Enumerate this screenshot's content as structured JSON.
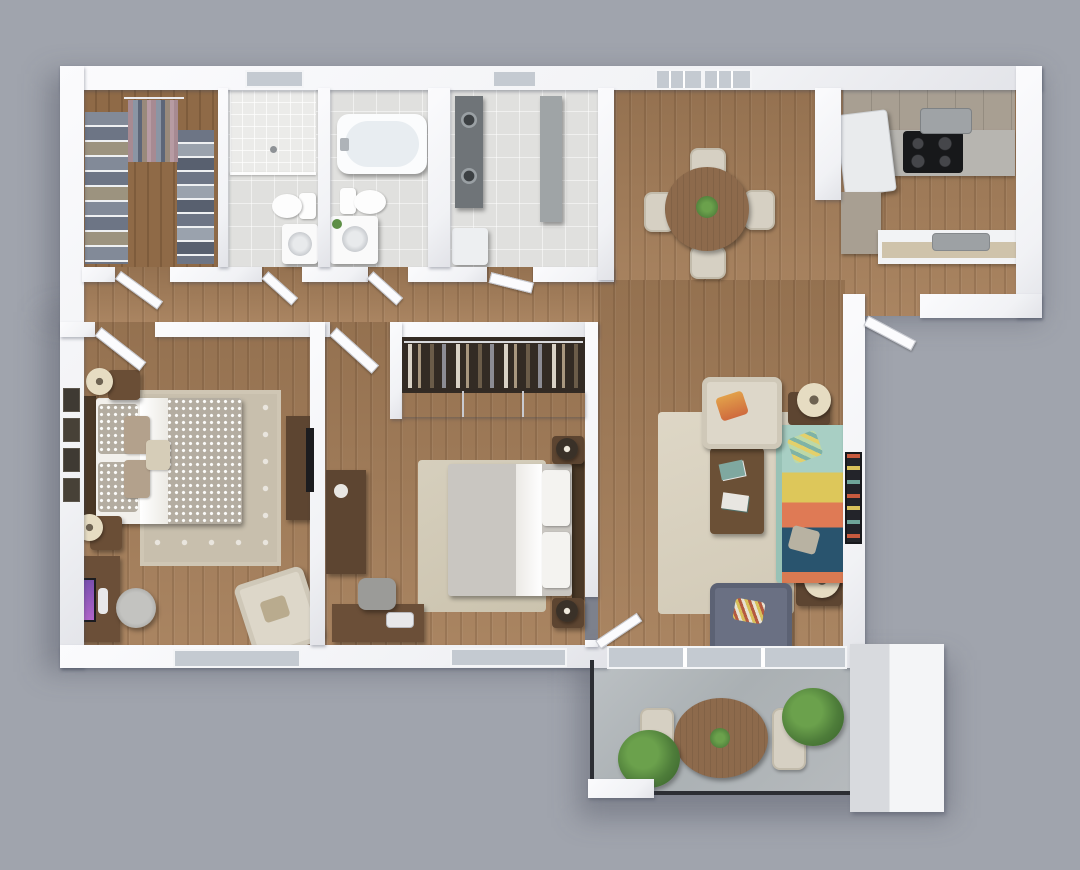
{
  "scene": {
    "label": "3D rendered top-down floor plan of a two-bedroom apartment with patio",
    "background": "#a0a4ad"
  },
  "palette": {
    "background": "#a0a4ad",
    "wall": "#f4f5f7",
    "wood_floor": "#a57e59",
    "closet_wood": "#8f6a47",
    "tile": "#e0e0de",
    "concrete": "#b3b8bb",
    "sofa_teal": "#a8cfc4",
    "sofa_yellow": "#ddc75a",
    "sofa_orange": "#df7a55",
    "sofa_navy": "#29546e",
    "accent_chair_gray": "#6a7083",
    "cream_fabric": "#ddd7c9",
    "dark_wood": "#5d4531",
    "table_wood": "#8d6a4c",
    "plant_green": "#4e7d3a",
    "rug_living": "#d9d2c1",
    "rug_master": "#c8bfad",
    "glass": "#c4cad1"
  },
  "rooms": {
    "walkin_closet": {
      "label": "Walk-in closet"
    },
    "bathroom_shower": {
      "label": "Bathroom with walk-in shower"
    },
    "bathroom_tub": {
      "label": "Bathroom with bathtub"
    },
    "laundry": {
      "label": "Laundry / utility room"
    },
    "hallway": {
      "label": "Hallway"
    },
    "kitchen_dining": {
      "label": "Kitchen and dining area"
    },
    "living": {
      "label": "Living room"
    },
    "master_bedroom": {
      "label": "Master bedroom"
    },
    "bedroom2": {
      "label": "Second bedroom"
    },
    "patio": {
      "label": "Private patio"
    }
  },
  "furniture": {
    "walkin_closet": [
      "Hanging clothes rack",
      "Folded clothes shelves (left)",
      "Folded clothes shelves (right)"
    ],
    "bathroom_shower": [
      "Walk-in shower",
      "Toilet",
      "Vanity with round sink"
    ],
    "bathroom_tub": [
      "Bathtub",
      "Toilet",
      "Vanity with round sink and plant"
    ],
    "laundry": [
      "Stacked washer and dryer",
      "Tall storage cabinet",
      "Utility box"
    ],
    "kitchen_dining": [
      "Refrigerator",
      "Upper cabinets",
      "Countertop",
      "Black cooktop",
      "Microwave",
      "Breakfast-bar counter with sink",
      "Round dining table",
      "Four dining chairs",
      "Centerpiece plant",
      "Two grid windows"
    ],
    "living": [
      "Striped sofa (teal, yellow, orange, navy)",
      "Cream armchair with orange pillow",
      "Gray armchair with striped pillow",
      "Dark wood coffee table with books",
      "End table with drum lamp (north)",
      "End table with drum lamp (south)",
      "Beige area rug",
      "Wall-mounted TV panel"
    ],
    "master_bedroom": [
      "Double bed with patterned duvet",
      "Nightstand with lamp (north)",
      "Nightstand with lamp (south)",
      "Trellis area rug",
      "Desk with monitor",
      "Office chair",
      "Cream accent chair",
      "Media console with TV",
      "Four wall frames",
      "Window"
    ],
    "bedroom2": [
      "Double bed with gray duvet",
      "Nightstand with lamp (north)",
      "Nightstand with lamp (south)",
      "Open closet with hanging clothes",
      "Dresser",
      "Desk with chair",
      "Area rug",
      "Window"
    ],
    "patio": [
      "Round outdoor dining table",
      "Two outdoor chairs",
      "Potted plant (corner)",
      "Potted plant (near wall)",
      "Black railing",
      "Sliding glass door"
    ]
  }
}
